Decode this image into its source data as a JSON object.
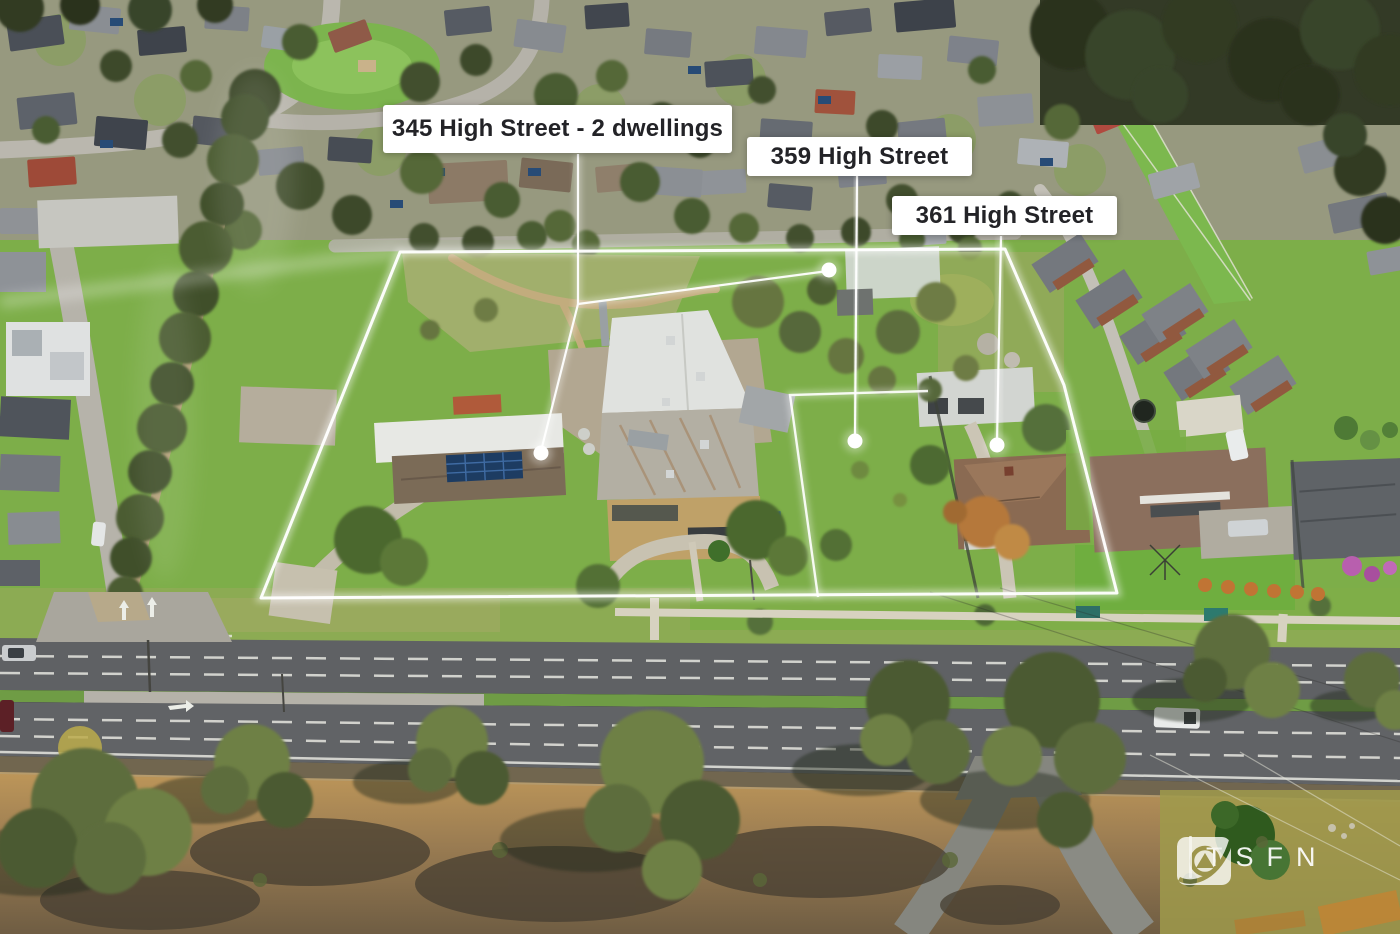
{
  "scene": {
    "description": "Aerial drone photograph of a suburban block: three adjoining properties outlined in white with leader lines and dots, High Street and gum trees in the foreground, dense housing estate behind"
  },
  "annotations": {
    "labels": [
      {
        "id": "label-345",
        "text": "345 High Street - 2 dwellings"
      },
      {
        "id": "label-359",
        "text": "359 High Street"
      },
      {
        "id": "label-361",
        "text": "361 High Street"
      }
    ]
  },
  "watermark": {
    "brand": "TSFN"
  },
  "palette": {
    "annotation_white": "#ffffff",
    "label_text": "#232327",
    "parcel_grass": "#7dae49",
    "road_asphalt": "#5f6164",
    "foreground_dirt": "#bd9659",
    "solar_panel_blue": "#1d3c62",
    "tree_green": "#55703a"
  }
}
